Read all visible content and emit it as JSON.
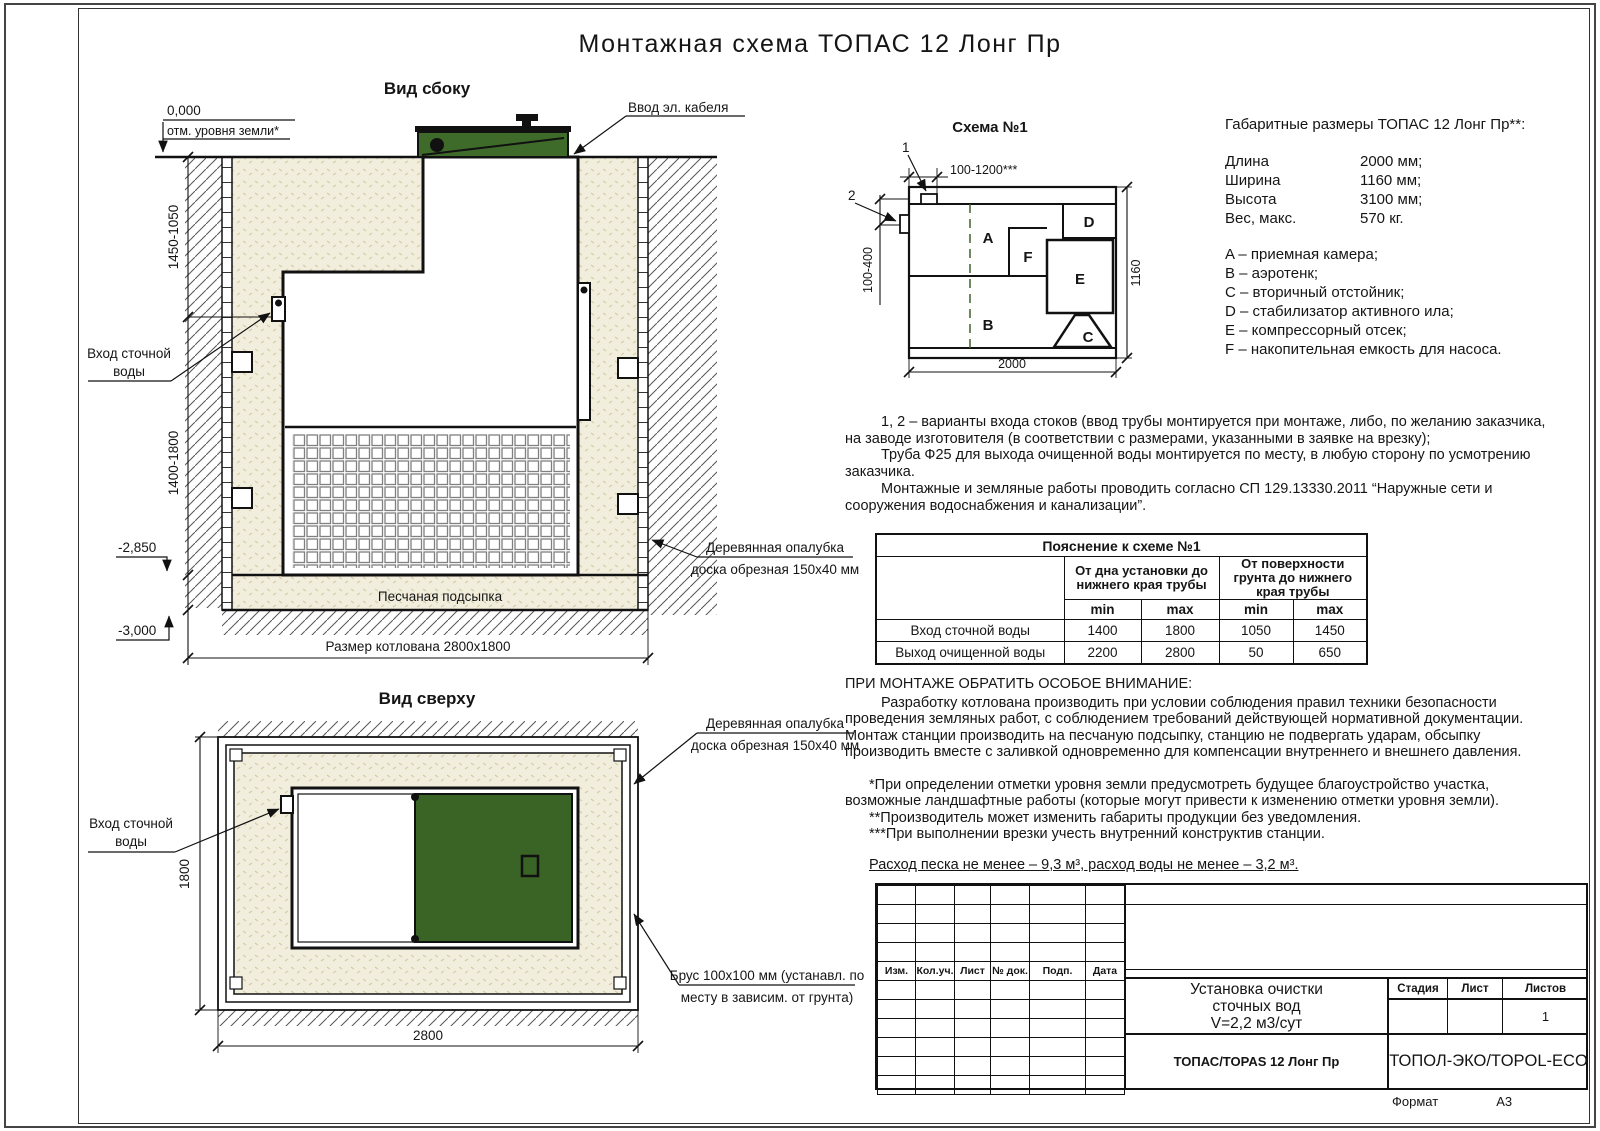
{
  "title": "Монтажная схема ТОПАС 12 Лонг Пр",
  "page": {
    "format_label": "Формат",
    "format_value": "А3"
  },
  "side_view": {
    "label": "Вид сбоку",
    "zero_mark": "0,000",
    "ground_note": "отм. уровня земли*",
    "dim_upper": "1450-1050",
    "dim_lower": "1400-1800",
    "mark_sand": "-2,850",
    "mark_bottom": "-3,000",
    "inlet_line1": "Вход сточной",
    "inlet_line2": "воды",
    "cable_label": "Ввод эл. кабеля",
    "sand_bed_label": "Песчаная подсыпка",
    "formwork_line1": "Деревянная опалубка",
    "formwork_line2": "доска обрезная 150х40 мм",
    "pit_dim_label": "Размер котлована 2800х1800"
  },
  "top_view": {
    "label": "Вид сверху",
    "dim_width": "2800",
    "dim_height": "1800",
    "inlet_line1": "Вход сточной",
    "inlet_line2": "воды",
    "formwork_line1": "Деревянная опалубка",
    "formwork_line2": "доска обрезная 150х40 мм",
    "beam_line1": "Брус 100х100 мм (устанавл. по",
    "beam_line2": "месту в зависим. от грунта)"
  },
  "scheme": {
    "title": "Схема №1",
    "callout_1": "1",
    "callout_2": "2",
    "dim_top": "100-1200***",
    "dim_left": "100-400",
    "dim_bottom": "2000",
    "dim_right": "1160",
    "label_a": "A",
    "label_b": "B",
    "label_c": "C",
    "label_d": "D",
    "label_e": "E",
    "label_f": "F"
  },
  "specs": {
    "title": "Габаритные размеры ТОПАС 12 Лонг Пр**:",
    "rows": [
      {
        "name": "Длина",
        "value": "2000 мм;"
      },
      {
        "name": "Ширина",
        "value": "1160 мм;"
      },
      {
        "name": "Высота",
        "value": "3100 мм;"
      },
      {
        "name": "Вес, макс.",
        "value": "570 кг."
      }
    ],
    "legend": [
      "A – приемная камера;",
      "B – аэротенк;",
      "C – вторичный отстойник;",
      "D – стабилизатор активного ила;",
      "E – компрессорный отсек;",
      "F – накопительная емкость для насоса."
    ]
  },
  "notes": {
    "para1": "1, 2 – варианты входа  стоков (ввод трубы монтируется при монтаже, либо, по желанию заказчика, на заводе изготовителя (в соответствии с размерами, указанными в заявке на врезку);",
    "para2": "Труба Ф25 для выхода очищенной воды монтируется по месту, в любую сторону по усмотрению заказчика.",
    "para3": "Монтажные и земляные работы проводить согласно СП 129.13330.2011 “Наружные сети и сооружения водоснабжения и канализации”."
  },
  "explain_table": {
    "title": "Пояснение к схеме №1",
    "group1": "От дна установки до нижнего края трубы",
    "group2": "От поверхности грунта до нижнего края трубы",
    "min": "min",
    "max": "max",
    "rows": [
      {
        "name": "Вход сточной воды",
        "c1": "1400",
        "c2": "1800",
        "c3": "1050",
        "c4": "1450"
      },
      {
        "name": "Выход очищенной воды",
        "c1": "2200",
        "c2": "2800",
        "c3": "50",
        "c4": "650"
      }
    ]
  },
  "warning": {
    "title": "ПРИ МОНТАЖЕ ОБРАТИТЬ ОСОБОЕ ВНИМАНИЕ:",
    "body": "Разработку котлована производить при условии соблюдения правил техники безопасности проведения земляных работ, с соблюдением требований действующей нормативной документации. Монтаж станции производить на песчаную подсыпку, станцию не подвергать ударам, обсыпку производить вместе с заливкой одновременно для компенсации внутреннего и внешнего давления.",
    "note1": "*При определении отметки уровня земли предусмотреть будущее благоустройство участка, возможные ландшафтные работы (которые могут привести к изменению отметки уровня земли).",
    "note2": "**Производитель может изменить габариты продукции без уведомления.",
    "note3": "***При выполнении врезки учесть внутренний конструктив станции.",
    "consumption": "Расход песка не менее – 9,3 м³, расход воды не менее – 3,2 м³."
  },
  "stamp": {
    "cols": [
      "Изм.",
      "Кол.уч.",
      "Лист",
      "№ док.",
      "Подп.",
      "Дата"
    ],
    "doc_line1": "Установка очистки",
    "doc_line2": "сточных вод",
    "doc_line3": "V=2,2 м3/сут",
    "stage": "Стадия",
    "sheet": "Лист",
    "sheets": "Листов",
    "sheets_value": "1",
    "product": "ТОПАС/TOPAS 12 Лонг Пр",
    "company": "ТОПОЛ-ЭКО/TOPOL-ECO"
  },
  "colors": {
    "lid_green": "#3e6b29",
    "plan_green": "#3a6326",
    "sand": "#f2eedd",
    "line": "#111111"
  }
}
